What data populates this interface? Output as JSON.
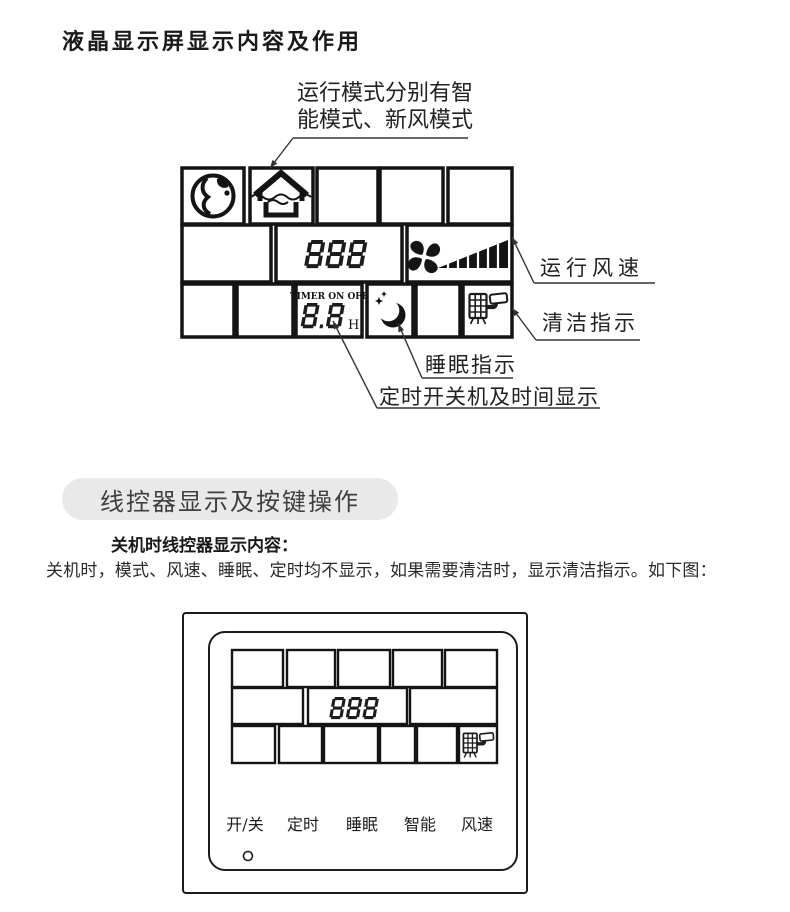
{
  "page_title": "液晶显示屏显示内容及作用",
  "lcd_diagram": {
    "annotation": {
      "line1": "运行模式分别有智",
      "line2": "能模式、新风模式"
    },
    "display": {
      "digits": "888",
      "timer_header": "TIMER ON OFF",
      "timer_digits": "8.8",
      "timer_unit": "H"
    },
    "labels": {
      "fan_speed": "运行风速",
      "clean": "清洁指示",
      "sleep": "睡眠指示",
      "timer": "定时开关机及时间显示"
    },
    "icons": [
      "globe-icon",
      "fresh-air-house-icon",
      "fan-icon",
      "fan-speed-bars-icon",
      "sleep-moon-icon",
      "clean-indicator-icon"
    ]
  },
  "controller_section": {
    "heading": "线控器显示及按键操作",
    "subheading": "关机时线控器显示内容：",
    "body": "关机时，模式、风速、睡眠、定时均不显示，如果需要清洁时，显示清洁指示。如下图：",
    "display": {
      "digits": "888"
    },
    "buttons": [
      {
        "label": "开/关"
      },
      {
        "label": "定时"
      },
      {
        "label": "睡眠"
      },
      {
        "label": "智能"
      },
      {
        "label": "风速"
      }
    ]
  },
  "colors": {
    "ink": "#1c1c1c",
    "pill_bg": "#e9e9e9",
    "pill_text": "#3f3f3f"
  }
}
